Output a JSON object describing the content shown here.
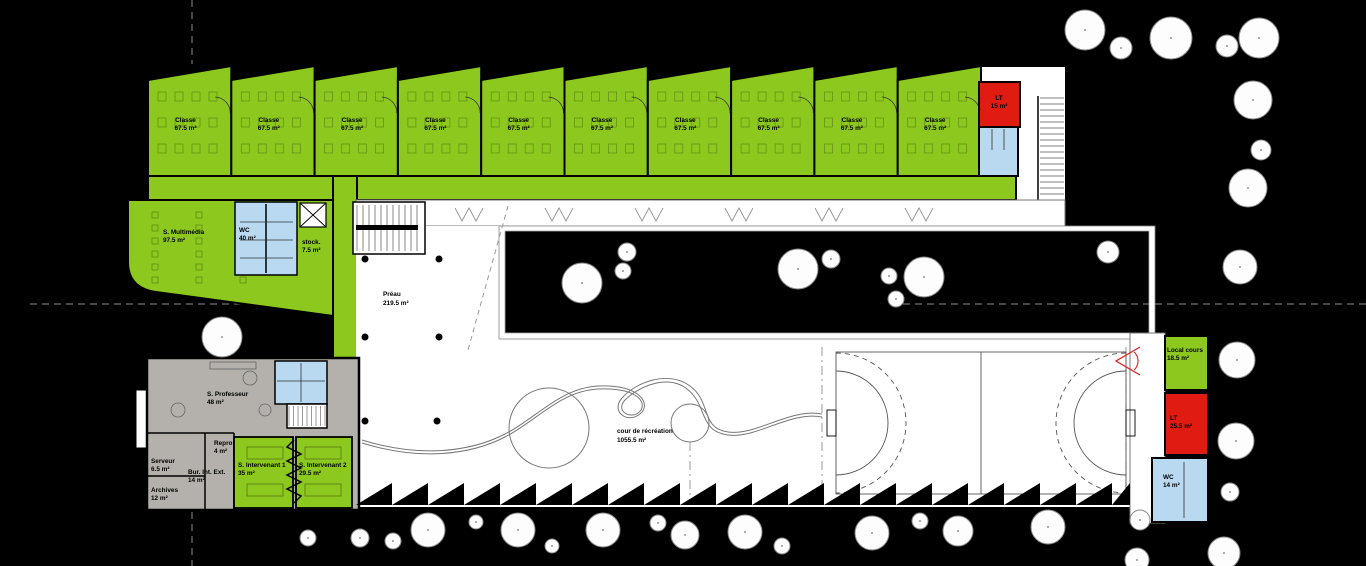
{
  "colors": {
    "room_green": "#8cc81e",
    "room_red": "#df1b12",
    "room_blue": "#b9d9f0",
    "room_gray": "#b4b1ac",
    "wall": "#000000",
    "paper": "#ffffff",
    "tree_fill": "#fdfdfd",
    "tree_stroke": "#8a8a8a",
    "boundary": "#8c8c8c",
    "court_red_mark": "#e02020"
  },
  "classroom_wing": {
    "count": 10,
    "room": {
      "label": "Classe",
      "area": "67.5 m²"
    }
  },
  "labels": {
    "lt_nord": {
      "label": "LT",
      "area": "15 m²"
    },
    "multimedia": {
      "label": "S. Multimédia",
      "area": "97.5 m²"
    },
    "wc40": {
      "label": "WC",
      "area": "40 m²"
    },
    "stock": {
      "label": "stock.",
      "area": "7.5 m²"
    },
    "preau": {
      "label": "Préau",
      "area": "219.5 m²"
    },
    "cour": {
      "label": "cour de récréation",
      "area": "1055.5 m²"
    },
    "professeur": {
      "label": "S. Professeur",
      "area": "48 m²"
    },
    "repro": {
      "label": "Repro",
      "area": "4 m²"
    },
    "serveur": {
      "label": "Serveur",
      "area": "6.5 m²"
    },
    "bur_int_ext": {
      "label": "Bur. Int. Ext.",
      "area": "14 m²"
    },
    "archives": {
      "label": "Archives",
      "area": "12 m²"
    },
    "intervenant1": {
      "label": "S. Intervenant 1",
      "area": "35 m²"
    },
    "intervenant2": {
      "label": "S. Intervenant 2",
      "area": "29.5 m²"
    },
    "local_cours": {
      "label": "Local cours",
      "area": "18.5 m²"
    },
    "lt_est": {
      "label": "LT",
      "area": "25.5 m²"
    },
    "wc14": {
      "label": "WC",
      "area": "14 m²"
    }
  },
  "trees": [
    [
      1085,
      30,
      20
    ],
    [
      1121,
      48,
      11
    ],
    [
      1171,
      38,
      21
    ],
    [
      1227,
      46,
      11
    ],
    [
      1259,
      38,
      20
    ],
    [
      1253,
      100,
      19
    ],
    [
      1261,
      150,
      10
    ],
    [
      1248,
      188,
      19
    ],
    [
      1240,
      267,
      17
    ],
    [
      1108,
      252,
      11
    ],
    [
      1237,
      360,
      18
    ],
    [
      1236,
      441,
      18
    ],
    [
      1230,
      492,
      9
    ],
    [
      1224,
      553,
      16
    ],
    [
      582,
      283,
      20
    ],
    [
      627,
      252,
      9
    ],
    [
      623,
      271,
      8
    ],
    [
      798,
      269,
      20
    ],
    [
      831,
      259,
      9
    ],
    [
      889,
      276,
      8
    ],
    [
      924,
      277,
      20
    ],
    [
      896,
      299,
      8
    ],
    [
      222,
      337,
      20
    ],
    [
      308,
      538,
      8
    ],
    [
      360,
      538,
      9
    ],
    [
      393,
      541,
      8
    ],
    [
      428,
      530,
      17
    ],
    [
      476,
      522,
      7
    ],
    [
      518,
      530,
      17
    ],
    [
      552,
      546,
      7
    ],
    [
      603,
      530,
      17
    ],
    [
      658,
      523,
      8
    ],
    [
      685,
      535,
      14
    ],
    [
      745,
      532,
      17
    ],
    [
      782,
      546,
      8
    ],
    [
      872,
      533,
      17
    ],
    [
      920,
      521,
      8
    ],
    [
      958,
      531,
      15
    ],
    [
      1048,
      527,
      17
    ],
    [
      1140,
      520,
      10
    ],
    [
      1137,
      560,
      12
    ]
  ]
}
